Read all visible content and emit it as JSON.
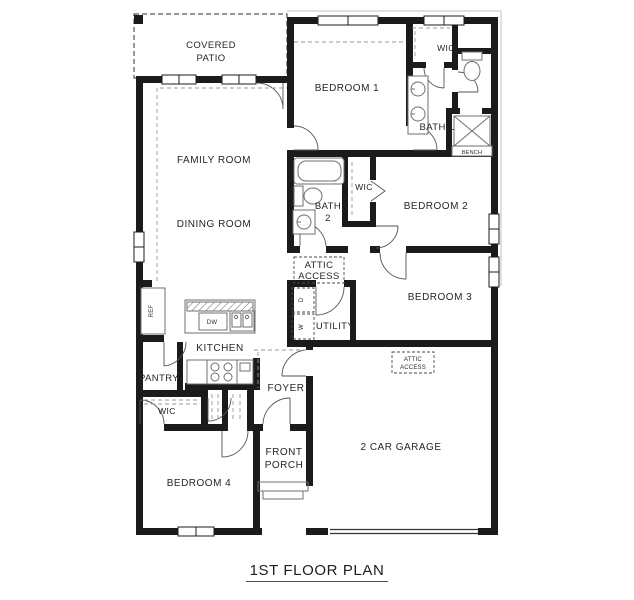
{
  "title": "1ST FLOOR PLAN",
  "colors": {
    "wall": "#1b1b1b",
    "fixture_line": "#6f6f6f",
    "dash": "#999999",
    "text": "#262626"
  },
  "rooms": {
    "covered_patio": {
      "line1": "COVERED",
      "line2": "PATIO"
    },
    "family_room": {
      "label": "FAMILY ROOM"
    },
    "dining_room": {
      "label": "DINING ROOM"
    },
    "kitchen": {
      "label": "KITCHEN"
    },
    "pantry": {
      "label": "PANTRY"
    },
    "foyer": {
      "label": "FOYER"
    },
    "front_porch": {
      "line1": "FRONT",
      "line2": "PORCH"
    },
    "bedroom1": {
      "label": "BEDROOM 1"
    },
    "bedroom2": {
      "label": "BEDROOM 2"
    },
    "bedroom3": {
      "label": "BEDROOM 3"
    },
    "bedroom4": {
      "label": "BEDROOM 4"
    },
    "bath1": {
      "label": "BATH 1"
    },
    "bath2": {
      "line1": "BATH",
      "line2": "2"
    },
    "wic_master": {
      "label": "WIC"
    },
    "wic_bed2": {
      "label": "WIC"
    },
    "wic_bed4": {
      "label": "WIC"
    },
    "utility": {
      "label": "UTILITY"
    },
    "garage": {
      "label": "2 CAR GARAGE"
    }
  },
  "fixtures": {
    "ref": "REF",
    "dw": "DW",
    "washer": "W",
    "dryer": "D",
    "bench": "BENCH",
    "attic_access_hall": {
      "line1": "ATTIC",
      "line2": "ACCESS"
    },
    "attic_access_garage": {
      "line1": "ATTIC",
      "line2": "ACCESS"
    }
  }
}
